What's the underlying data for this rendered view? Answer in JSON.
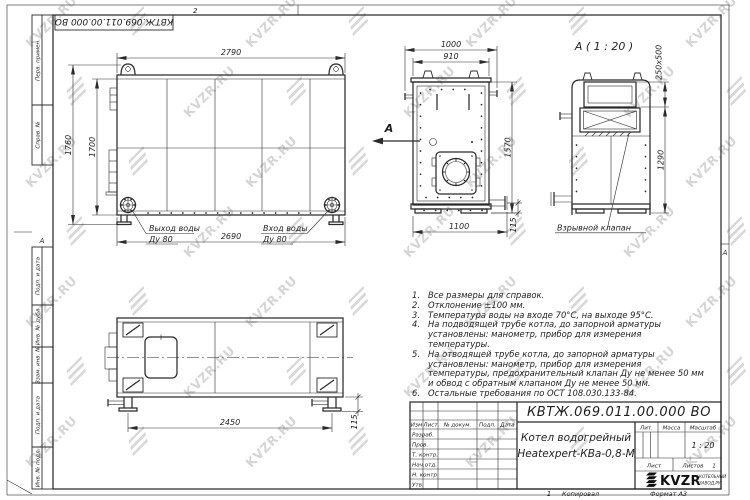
{
  "watermark": {
    "text": "KVZR.RU"
  },
  "page": {
    "zone_top": "2",
    "zone_bottom": "1",
    "zone_side": "А",
    "copied_label": "Копировал",
    "format_label": "Формат А3"
  },
  "stamp_top": "КВТЖ.069.011.00.000 ВО",
  "margin_fields": [
    "Перв. примен.",
    "Справ. №",
    "Подп. и дата",
    "Инв. № дубл.",
    "Взам. инв. №",
    "Подп. и дата",
    "Инв. № подл."
  ],
  "views": {
    "arrow_label": "А",
    "side": {
      "dim_top": "2790",
      "dim_h_outer": "1760",
      "dim_h_inner": "1700",
      "dim_bottom": "2690",
      "outlet_line1": "Выход воды",
      "outlet_line2": "Ду 80",
      "inlet_line1": "Вход воды",
      "inlet_line2": "Ду 80"
    },
    "front": {
      "dim_overall_w": "1000",
      "dim_body_w": "910",
      "dim_h": "1570",
      "dim_base": "1100",
      "dim_pipe_h": "115"
    },
    "rear": {
      "title": "А ( 1 : 20 )",
      "dim_flue": "250х500",
      "dim_h": "1290",
      "valve_label": "Взрывной клапан"
    },
    "plan": {
      "dim_legs": "2450",
      "dim_pipe_h": "115"
    }
  },
  "notes": {
    "items": [
      {
        "n": "1.",
        "text": "Все размеры для справок."
      },
      {
        "n": "2.",
        "text": "Отклонение ±100 мм."
      },
      {
        "n": "3.",
        "text": "Температура воды на входе 70°С, на выходе 95°С."
      },
      {
        "n": "4.",
        "text": "На подводящей трубе котла, до запорной арматуры установлены: манометр, прибор для измерения температуры."
      },
      {
        "n": "5.",
        "text": "На отводящей трубе котла, до запорной арматуры установлены: манометр, прибор для измерения температуры, предохранительный клапан Ду не менее 50 мм и обвод с обратным клапаном Ду не менее 50 мм."
      },
      {
        "n": "6.",
        "text": "Остальные требования по ОСТ 108.030.133-84."
      }
    ]
  },
  "title_block": {
    "doc_number": "КВТЖ.069.011.00.000 ВО",
    "product_name_line1": "Котел водогрейный",
    "product_name_line2": "Heatexpert-КВа-0,8-М",
    "header_cols": [
      "Изм",
      "Лист",
      "№ докум.",
      "Подп.",
      "Дата"
    ],
    "sig_rows": [
      "Разраб.",
      "Пров.",
      "Т. контр.",
      "Нач.отд.",
      "Н. контр.",
      "Утв."
    ],
    "lit_label": "Лит.",
    "mass_label": "Масса",
    "scale_label": "Масштаб",
    "scale_value": "1 : 20",
    "sheet_label": "Лист",
    "sheets_label": "Листов",
    "sheets_value": "1",
    "logo_text": "KVZR",
    "logo_sub1": "КОТЕЛЬНЫЙ",
    "logo_sub2": "ЗАВОД.РУ"
  }
}
